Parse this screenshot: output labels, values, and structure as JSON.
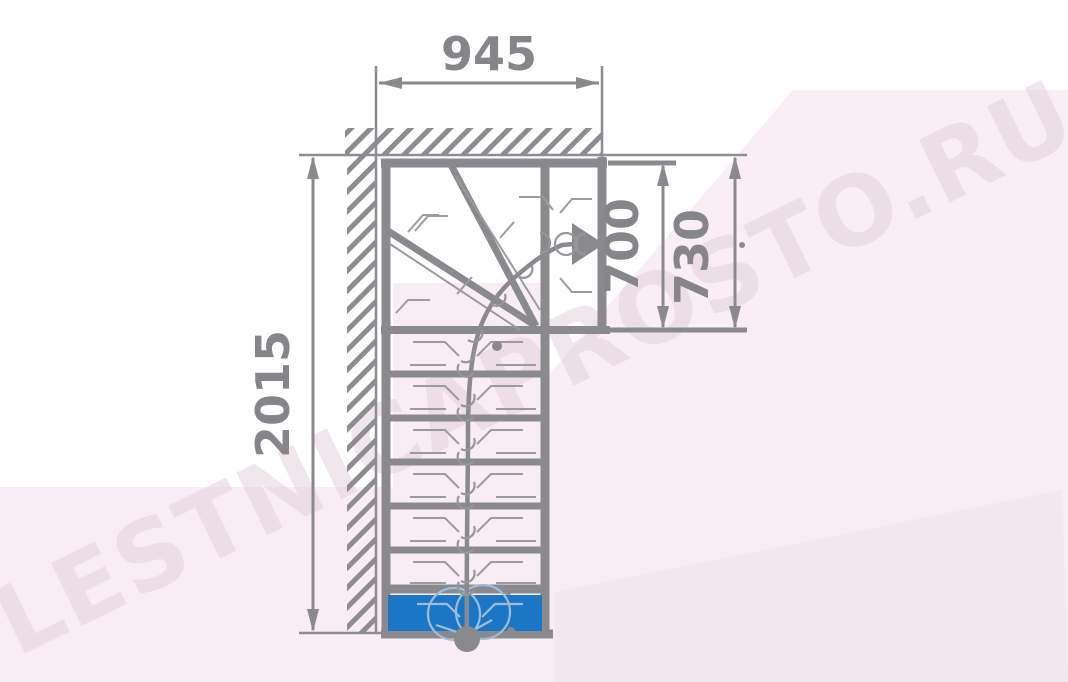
{
  "watermark": {
    "text": "LESTNICAPROSTO.RU"
  },
  "dimensions": {
    "width_top": {
      "label": "945"
    },
    "length_left": {
      "label": "2015"
    },
    "landing_inner": {
      "label": "700"
    },
    "landing_outer": {
      "label": "730"
    }
  },
  "colors": {
    "line_gray": "#8a8a8e",
    "detail_gray": "#9b9b9f",
    "first_step_blue": "#1b76c6",
    "background_tint": "#f8edf4",
    "watermark_text": "#decbd8"
  },
  "icons": {
    "direction_arrow": "filled-triangle-right",
    "walk_line_start": "filled-circle"
  }
}
